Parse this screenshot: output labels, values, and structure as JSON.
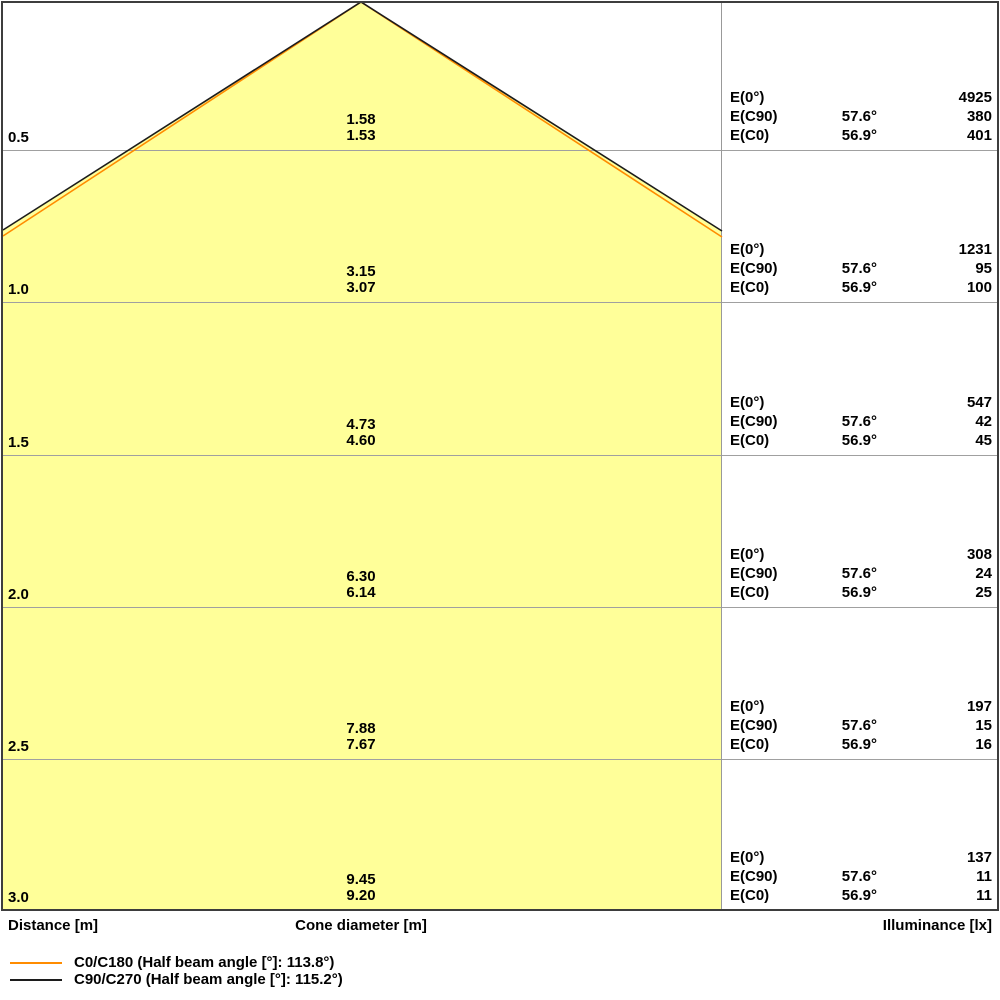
{
  "chart_data": {
    "type": "area",
    "title": "Light cone diagram",
    "xlabel": "Distance [m]",
    "ylabel_center": "Cone diameter [m]",
    "ylabel_right": "Illuminance [lx]",
    "distances_m": [
      0.5,
      1.0,
      1.5,
      2.0,
      2.5,
      3.0
    ],
    "series": [
      {
        "name": "C0/C180",
        "half_beam_angle_deg": 113.8,
        "angle_label": "56.9°",
        "color": "#FF8C00",
        "cone_diameter_m": [
          1.53,
          3.07,
          4.6,
          6.14,
          7.67,
          9.2
        ],
        "illuminance_lx": [
          401,
          100,
          45,
          25,
          16,
          11
        ]
      },
      {
        "name": "C90/C270",
        "half_beam_angle_deg": 115.2,
        "angle_label": "57.6°",
        "color": "#1C1C1C",
        "cone_diameter_m": [
          1.58,
          3.15,
          4.73,
          6.3,
          7.88,
          9.45
        ],
        "illuminance_lx": [
          380,
          95,
          42,
          24,
          15,
          11
        ]
      },
      {
        "name": "E(0°)",
        "illuminance_lx": [
          4925,
          1231,
          547,
          308,
          197,
          137
        ]
      }
    ],
    "legend_position": "bottom-left",
    "grid": true
  },
  "axes": {
    "distance": "Distance [m]",
    "cone_diameter": "Cone diameter [m]",
    "illuminance": "Illuminance [lx]"
  },
  "colors": {
    "cone_fill": "#FFFF99",
    "c0_line": "#FF8C00",
    "c90_line": "#1C1C1C",
    "grid_line": "#A0A0A0",
    "divider_line": "#999999",
    "border": "#3D3D3D"
  },
  "table": {
    "rows": [
      {
        "distance": "0.5",
        "cone_c90": "1.58",
        "cone_c0": "1.53",
        "e0_label": "E(0°)",
        "e0_value": "4925",
        "ec90_label": "E(C90)",
        "ec90_angle": "57.6°",
        "ec90_value": "380",
        "ec0_label": "E(C0)",
        "ec0_angle": "56.9°",
        "ec0_value": "401"
      },
      {
        "distance": "1.0",
        "cone_c90": "3.15",
        "cone_c0": "3.07",
        "e0_label": "E(0°)",
        "e0_value": "1231",
        "ec90_label": "E(C90)",
        "ec90_angle": "57.6°",
        "ec90_value": "95",
        "ec0_label": "E(C0)",
        "ec0_angle": "56.9°",
        "ec0_value": "100"
      },
      {
        "distance": "1.5",
        "cone_c90": "4.73",
        "cone_c0": "4.60",
        "e0_label": "E(0°)",
        "e0_value": "547",
        "ec90_label": "E(C90)",
        "ec90_angle": "57.6°",
        "ec90_value": "42",
        "ec0_label": "E(C0)",
        "ec0_angle": "56.9°",
        "ec0_value": "45"
      },
      {
        "distance": "2.0",
        "cone_c90": "6.30",
        "cone_c0": "6.14",
        "e0_label": "E(0°)",
        "e0_value": "308",
        "ec90_label": "E(C90)",
        "ec90_angle": "57.6°",
        "ec90_value": "24",
        "ec0_label": "E(C0)",
        "ec0_angle": "56.9°",
        "ec0_value": "25"
      },
      {
        "distance": "2.5",
        "cone_c90": "7.88",
        "cone_c0": "7.67",
        "e0_label": "E(0°)",
        "e0_value": "197",
        "ec90_label": "E(C90)",
        "ec90_angle": "57.6°",
        "ec90_value": "15",
        "ec0_label": "E(C0)",
        "ec0_angle": "56.9°",
        "ec0_value": "16"
      },
      {
        "distance": "3.0",
        "cone_c90": "9.45",
        "cone_c0": "9.20",
        "e0_label": "E(0°)",
        "e0_value": "137",
        "ec90_label": "E(C90)",
        "ec90_angle": "57.6°",
        "ec90_value": "11",
        "ec0_label": "E(C0)",
        "ec0_angle": "56.9°",
        "ec0_value": "11"
      }
    ]
  },
  "legend": {
    "items": [
      {
        "label": "C0/C180 (Half beam angle [°]: 113.8°)",
        "color": "#FF8C00"
      },
      {
        "label": "C90/C270 (Half beam angle [°]: 115.2°)",
        "color": "#1C1C1C"
      }
    ]
  }
}
